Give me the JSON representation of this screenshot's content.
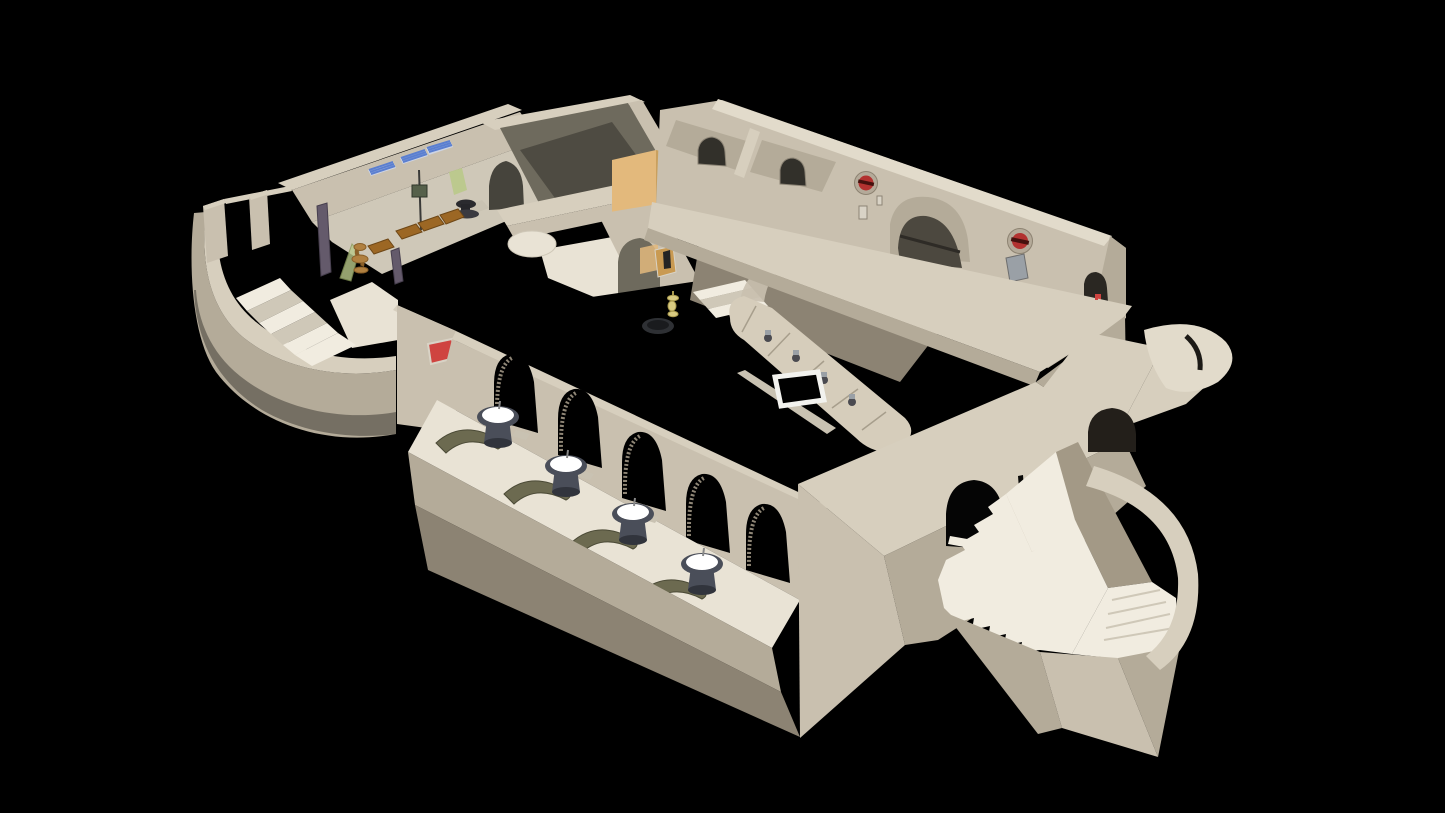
{
  "palette": {
    "bg": "#000000",
    "roof": "#d7cfbe",
    "roof_bright": "#e2dbcb",
    "wall_front": "#c9c0af",
    "wall_side": "#b4ab99",
    "wall_dark": "#a39986",
    "wall_shadow": "#8c8373",
    "wall_deep": "#6e6a5d",
    "room_shadow": "#4e4b42",
    "floor_light": "#e9e3d5",
    "stair_light": "#f1ece0",
    "stair_shade": "#cfc8b8",
    "orange_wall": "#e3b97c",
    "orange_dark": "#c9a05e",
    "niche_orange": "#c99a52",
    "red_vent": "#b23230",
    "red_vent_dark": "#45110e",
    "vent_ring": "#b4aa99",
    "red_sign": "#cf4440",
    "sign_frame": "#d9d3c6",
    "rack_blue": "#5b7fd0",
    "rack_frame": "#cdd4e4",
    "crate_wood": "#9c6724",
    "crate_dark": "#6e4716",
    "booth_olive": "#6c6a50",
    "booth_dark": "#4b4a36",
    "table_top_glow": "#ffffff",
    "table_body": "#4a4e59",
    "table_dark": "#31343c",
    "pillar_purple": "#645a6b",
    "bronze": "#b08040",
    "gold": "#d9cb82",
    "pot_dark": "#2e3034",
    "metal_gray": "#9aa0a6",
    "bar_top": "#d6cdbb",
    "bar_face": "#c3baa8",
    "plant_green": "#b9c98a",
    "rail_light": "#c9c2b2"
  },
  "scene": {
    "type": "3d-isometric-cutaway-render",
    "subject": "Cutaway dollhouse render of a desert cantina-style building interior on a black void background",
    "counts": {
      "glowing_tables": 4,
      "arcade_arches": 5,
      "red_wall_vents": 2,
      "blue_bottle_racks": 3,
      "booth_seats": 4,
      "staircases": 2
    },
    "features": [
      {
        "id": "left-annex",
        "label": "curved side-entrance stairwell"
      },
      {
        "id": "storage-room",
        "label": "back room with bottle racks and crates"
      },
      {
        "id": "dark-back-room",
        "label": "unlit storage room"
      },
      {
        "id": "orange-wall",
        "label": "orange painted wall segment"
      },
      {
        "id": "north-wing",
        "label": "alcove wing with arched doorways and red vents"
      },
      {
        "id": "roof-slab",
        "label": "long diagonal roof slab"
      },
      {
        "id": "bar-area",
        "label": "central sunken bar with curved counter and taps"
      },
      {
        "id": "light-frame",
        "label": "white square floor light"
      },
      {
        "id": "arcade-hall",
        "label": "arcade hall with five arches, glowing tables and booths"
      },
      {
        "id": "red-sign",
        "label": "red wall sign"
      },
      {
        "id": "front-right-block",
        "label": "massive front block with arched door"
      },
      {
        "id": "grand-staircase",
        "label": "wide zigzag entrance staircase"
      },
      {
        "id": "round-entrance",
        "label": "curved entrance rotunda walls"
      }
    ]
  }
}
